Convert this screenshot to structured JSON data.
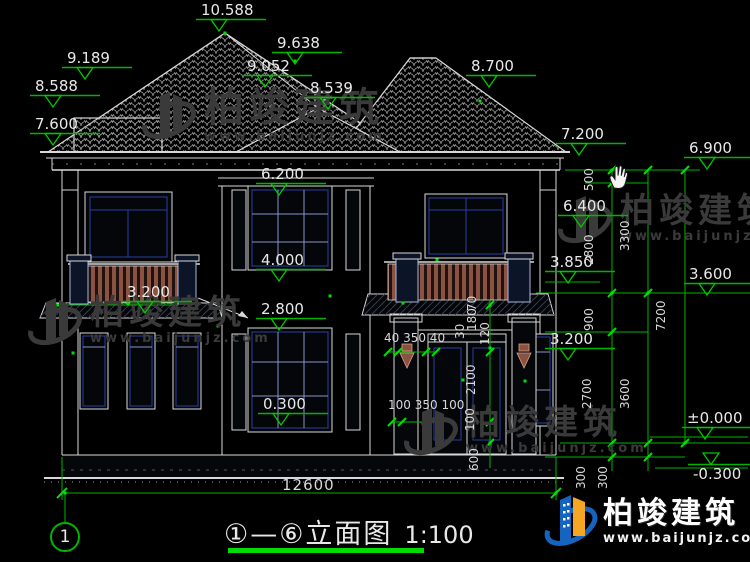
{
  "colors": {
    "background": "#000000",
    "line_white": "#d8d8d8",
    "dim_green": "#00b400",
    "grip_green": "#00e000",
    "window_blue": "#2e3f9e",
    "railing_brown": "#8a5242",
    "watermark_gray": "#3a3a3a",
    "logo_blue": "#1565c0",
    "logo_orange": "#f5a623"
  },
  "title": {
    "axis_bubble": "1",
    "text": "①—⑥立面图",
    "scale": "1:100"
  },
  "icons": {
    "cursor": "hand-cursor-icon",
    "elevation_marker": "open-triangle-level-symbol"
  },
  "elevations": [
    {
      "text": "10.588",
      "x": 196,
      "y": 2
    },
    {
      "text": "9.638",
      "x": 272,
      "y": 35
    },
    {
      "text": "9.052",
      "x": 242,
      "y": 58
    },
    {
      "text": "8.539",
      "x": 305,
      "y": 80
    },
    {
      "text": "9.189",
      "x": 62,
      "y": 50
    },
    {
      "text": "8.588",
      "x": 30,
      "y": 78
    },
    {
      "text": "7.600",
      "x": 30,
      "y": 116
    },
    {
      "text": "8.700",
      "x": 466,
      "y": 58
    },
    {
      "text": "7.200",
      "x": 556,
      "y": 126
    },
    {
      "text": "6.900",
      "x": 684,
      "y": 140
    },
    {
      "text": "6.400",
      "x": 558,
      "y": 198
    },
    {
      "text": "6.200",
      "x": 256,
      "y": 166
    },
    {
      "text": "4.000",
      "x": 256,
      "y": 252
    },
    {
      "text": "3.850",
      "x": 545,
      "y": 254
    },
    {
      "text": "3.600",
      "x": 684,
      "y": 266
    },
    {
      "text": "3.200",
      "x": 122,
      "y": 284
    },
    {
      "text": "2.800",
      "x": 256,
      "y": 301
    },
    {
      "text": "3.200",
      "x": 545,
      "y": 331
    },
    {
      "text": "0.300",
      "x": 258,
      "y": 396
    },
    {
      "text": "±0.000",
      "x": 682,
      "y": 410
    },
    {
      "text": "-0.300",
      "x": 688,
      "y": 452,
      "cls": "flip"
    }
  ],
  "vdims": [
    {
      "text": "500",
      "x": 596,
      "y": 178
    },
    {
      "text": "2800",
      "x": 596,
      "y": 252
    },
    {
      "text": "900",
      "x": 596,
      "y": 318
    },
    {
      "text": "2700",
      "x": 594,
      "y": 396
    },
    {
      "text": "300",
      "x": 588,
      "y": 476
    },
    {
      "text": "300",
      "x": 610,
      "y": 476
    },
    {
      "text": "3300",
      "x": 632,
      "y": 238
    },
    {
      "text": "3600",
      "x": 632,
      "y": 396
    },
    {
      "text": "7200",
      "x": 668,
      "y": 318
    },
    {
      "text": "70",
      "x": 479,
      "y": 298
    },
    {
      "text": "180",
      "x": 479,
      "y": 318
    },
    {
      "text": "30",
      "x": 467,
      "y": 326
    },
    {
      "text": "120",
      "x": 492,
      "y": 332
    },
    {
      "text": "2100",
      "x": 478,
      "y": 382
    },
    {
      "text": "100",
      "x": 477,
      "y": 418
    },
    {
      "text": "600",
      "x": 481,
      "y": 458
    }
  ],
  "hdims": [
    {
      "text": "40 350 40",
      "x": 384,
      "y": 331
    },
    {
      "text": "100 350 100",
      "x": 388,
      "y": 398
    },
    {
      "text": "12600",
      "x": 282,
      "y": 476,
      "cls": "dim-m"
    }
  ],
  "watermarks": [
    {
      "brand": "柏竣建筑",
      "url": "www.baijunjz.com",
      "x": 140,
      "y": 84,
      "cls": "wm-a"
    },
    {
      "brand": "柏竣建筑",
      "url": "www.baijunjz.com",
      "x": 26,
      "y": 290,
      "cls": "wm-b"
    },
    {
      "brand": "柏竣建筑",
      "url": "www.baijunjz.com",
      "x": 556,
      "y": 188,
      "cls": "wm-c"
    },
    {
      "brand": "柏竣建筑",
      "url": "www.baijunjz.com",
      "x": 402,
      "y": 400,
      "cls": "wm-d"
    }
  ],
  "logo": {
    "brand": "柏竣建筑",
    "url": "www.baijunjz.com"
  }
}
